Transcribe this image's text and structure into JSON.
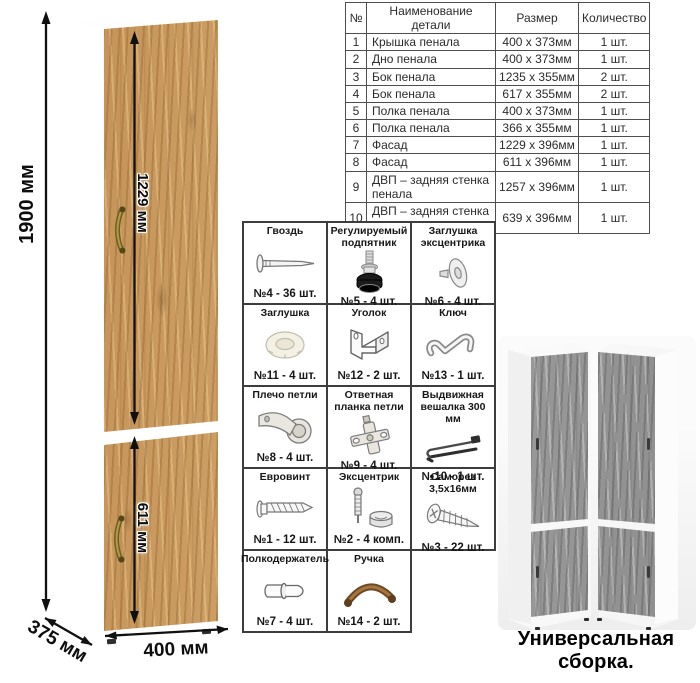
{
  "cabinet": {
    "dim_height": "1900 мм",
    "dim_door_upper": "1229 мм",
    "dim_door_lower": "611 мм",
    "dim_width": "400 мм",
    "dim_depth": "375 мм"
  },
  "parts_table": {
    "headers": [
      "№",
      "Наименование детали",
      "Размер",
      "Количество"
    ],
    "rows": [
      [
        "1",
        "Крышка пенала",
        "400 х 373мм",
        "1 шт."
      ],
      [
        "2",
        "Дно пенала",
        "400 х 373мм",
        "1 шт."
      ],
      [
        "3",
        "Бок пенала",
        "1235 х 355мм",
        "2 шт."
      ],
      [
        "4",
        "Бок пенала",
        "617 х 355мм",
        "2 шт."
      ],
      [
        "5",
        "Полка пенала",
        "400 х 373мм",
        "1 шт."
      ],
      [
        "6",
        "Полка пенала",
        "366 х 355мм",
        "1 шт."
      ],
      [
        "7",
        "Фасад",
        "1229 х 396мм",
        "1 шт."
      ],
      [
        "8",
        "Фасад",
        "611 х 396мм",
        "1 шт."
      ],
      [
        "9",
        "ДВП – задняя стенка пенала",
        "1257 х 396мм",
        "1 шт."
      ],
      [
        "10",
        "ДВП – задняя стенка пенала",
        "639 х 396мм",
        "1 шт."
      ]
    ]
  },
  "hardware": {
    "items": [
      {
        "name": "Гвоздь",
        "count": "№4 - 36 шт.",
        "icon": "nail-icon"
      },
      {
        "name": "Регулируемый подпятник",
        "count": "№5 - 4 шт.",
        "icon": "adjustable-foot-icon"
      },
      {
        "name": "Заглушка эксцентрика",
        "count": "№6 - 4 шт.",
        "icon": "eccentric-plug-icon"
      },
      {
        "name": "Заглушка",
        "count": "№11 - 4 шт.",
        "icon": "plug-icon"
      },
      {
        "name": "Уголок",
        "count": "№12 - 2 шт.",
        "icon": "corner-bracket-icon"
      },
      {
        "name": "Ключ",
        "count": "№13 - 1 шт.",
        "icon": "key-icon"
      },
      {
        "name": "Плечо петли",
        "count": "№8 - 4 шт.",
        "icon": "hinge-arm-icon"
      },
      {
        "name": "Ответная планка петли",
        "count": "№9 - 4 шт.",
        "icon": "hinge-plate-icon"
      },
      {
        "name": "Выдвижная вешалка 300 мм",
        "count": "№10 - 1 шт.",
        "icon": "pullout-hanger-icon"
      },
      {
        "name": "Евровинт",
        "count": "№1 - 12 шт.",
        "icon": "euroscrew-icon"
      },
      {
        "name": "Эксцентрик",
        "count": "№2 - 4 комп.",
        "icon": "eccentric-cam-icon"
      },
      {
        "name": "Саморез 3,5х16мм",
        "count": "№3 - 22 шт.",
        "icon": "self-tapping-screw-icon"
      },
      {
        "name": "Полкодержатель",
        "count": "№7 - 4 шт.",
        "icon": "shelf-pin-icon"
      },
      {
        "name": "Ручка",
        "count": "№14 - 2 шт.",
        "icon": "handle-icon"
      }
    ]
  },
  "footer": {
    "caption": "Универсальная сборка."
  },
  "colors": {
    "wood_oak": "#c79a62",
    "wood_gray": "#9d9d9d",
    "handle_bronze": "#8a6a35",
    "dimension_text": "#0d0d0d",
    "table_border": "#4e4e4e"
  }
}
